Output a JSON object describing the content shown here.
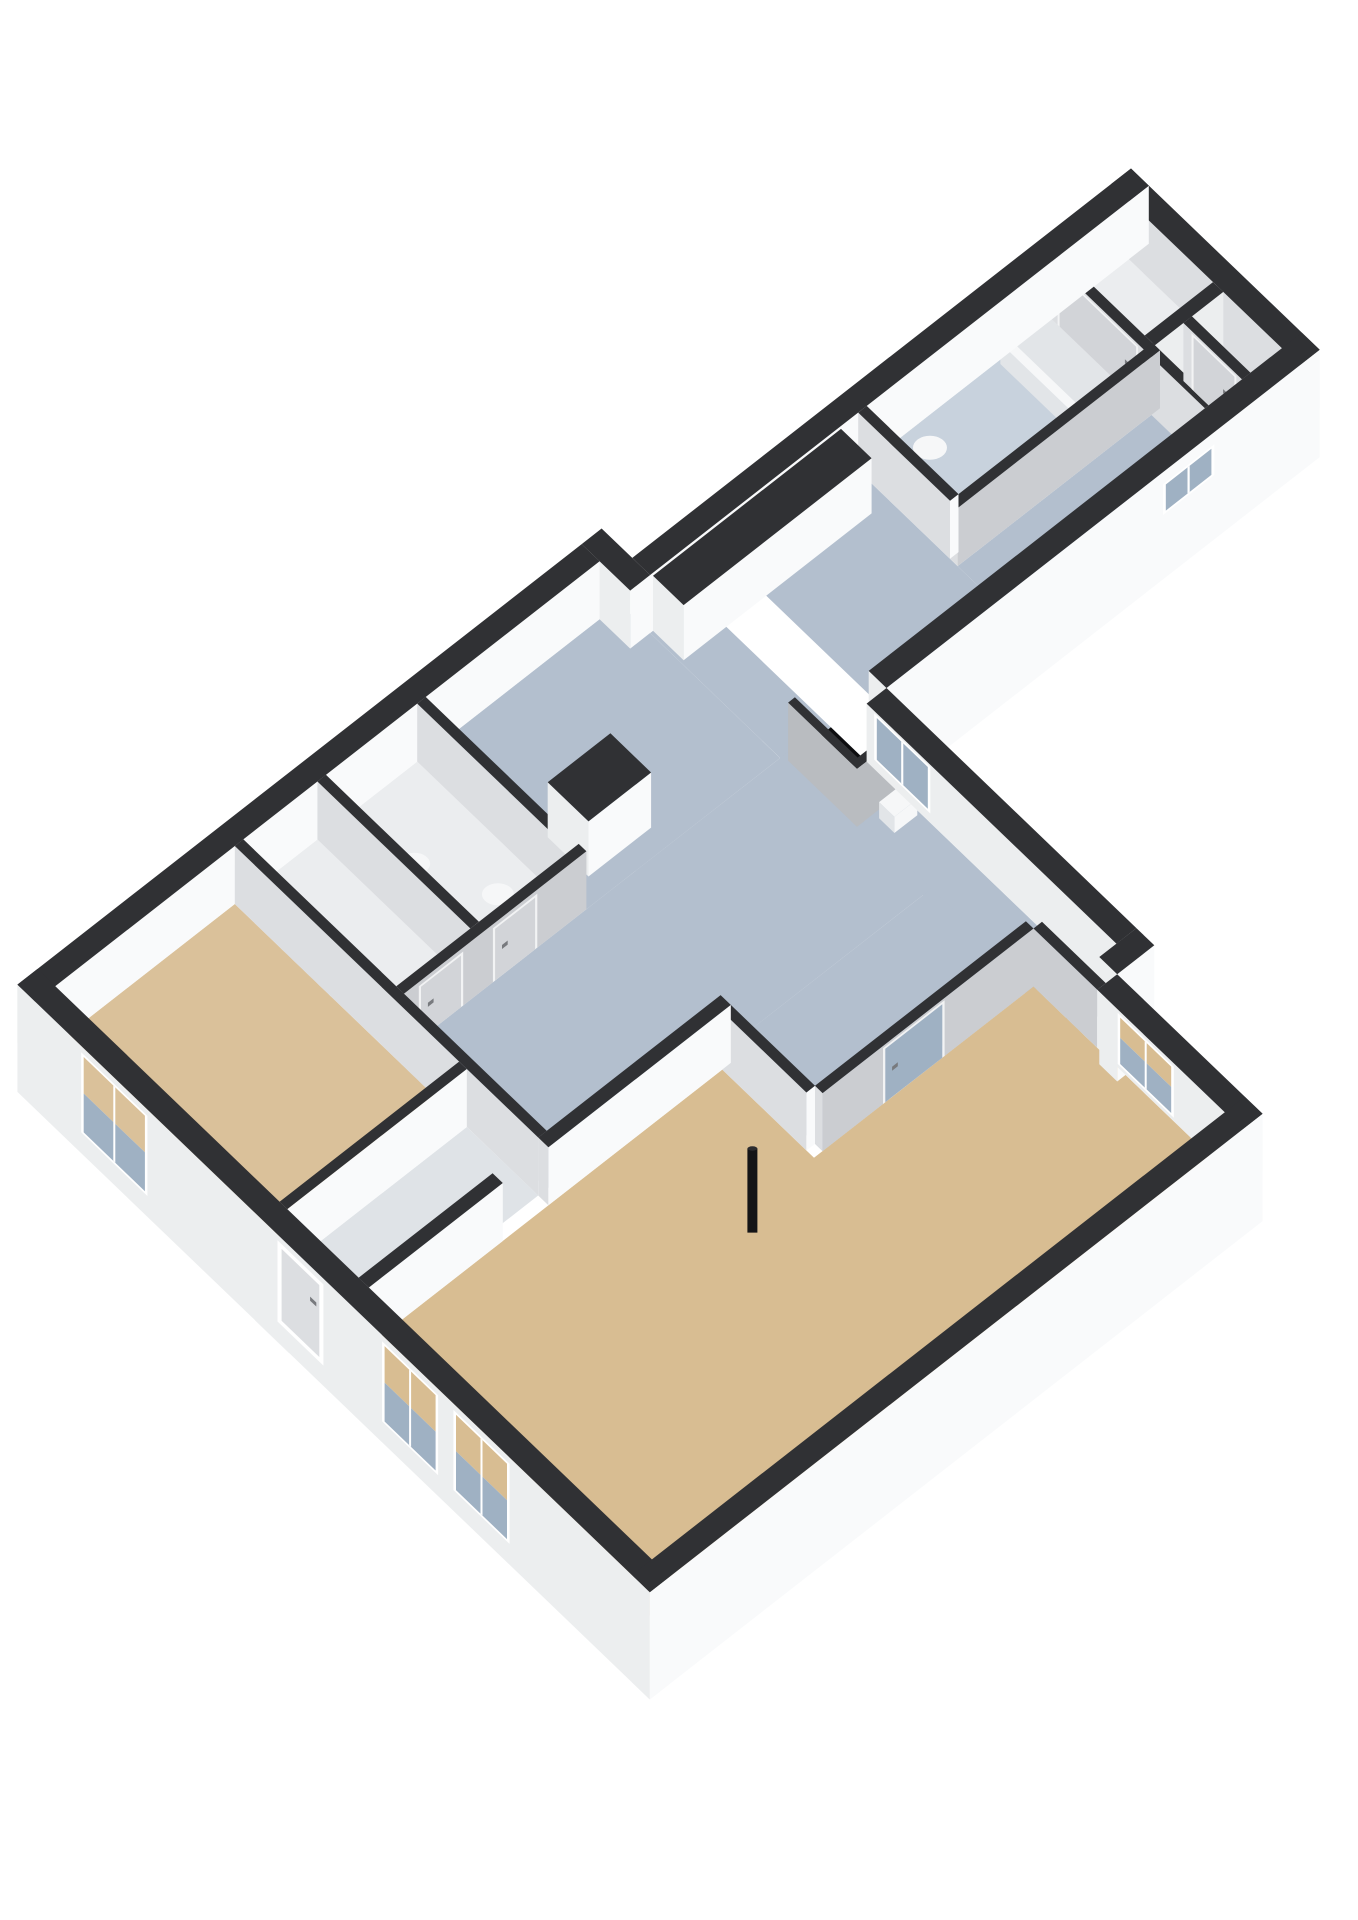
{
  "title": "3D cutaway floor plan (isometric view)",
  "view": "axonometric-cutaway",
  "background": "#ffffff",
  "palette": {
    "wall_cap": "#303134",
    "wall_face_bright": "#f9fafb",
    "wall_face_light": "#eceeef",
    "wall_face_mid": "#dcdee1",
    "wall_face_gray": "#cbcdd1",
    "door_panel": "#d2d4d8",
    "door_frame": "#f2f3f4",
    "door_handle": "#787a7e",
    "glass": "#9fb1c3",
    "glass_light": "#c3cdd8",
    "stair_void": "#0d0d0f",
    "stair_wall": "#b9bcc0",
    "flue_black": "#141416",
    "fixture_white": "#f6f7f8",
    "fixture_inner": "#e2e5e8"
  },
  "rooms": [
    {
      "id": "living-room",
      "label": "Living room",
      "floor_color": "#d8bd92"
    },
    {
      "id": "bedroom",
      "label": "Bedroom",
      "floor_color": "#dac19a"
    },
    {
      "id": "hall",
      "label": "Hall / landing",
      "floor_color": "#b3bfce"
    },
    {
      "id": "kitchen-zone",
      "label": "Kitchen zone",
      "floor_color": "#b3bfce"
    },
    {
      "id": "corridor",
      "label": "Corridor (rear wing)",
      "floor_color": "#b3bfce"
    },
    {
      "id": "bathroom-rear",
      "label": "Bathroom (rear wing)",
      "floor_color": "#c8d2dd"
    },
    {
      "id": "bathroom-front",
      "label": "Bathroom",
      "floor_color": "#ebedef"
    },
    {
      "id": "toilet-room",
      "label": "Toilet room",
      "floor_color": "#ebedef"
    },
    {
      "id": "entry",
      "label": "Entry",
      "floor_color": "#dfe3e7"
    },
    {
      "id": "closet-a",
      "label": "Closet",
      "floor_color": "#ebedef"
    },
    {
      "id": "closet-b",
      "label": "Closet",
      "floor_color": "#ebedef"
    }
  ],
  "fixtures": [
    {
      "id": "bathtub",
      "label": "Bathtub"
    },
    {
      "id": "toilet-rear",
      "label": "Toilet"
    },
    {
      "id": "toilet-front",
      "label": "Toilet"
    },
    {
      "id": "washbasin",
      "label": "Washbasin"
    },
    {
      "id": "kitchen-counter-long",
      "label": "Kitchen counter (dark top)"
    },
    {
      "id": "kitchen-counter-short",
      "label": "Kitchen counter (dark top)"
    },
    {
      "id": "stair-opening",
      "label": "Stair opening (void)"
    },
    {
      "id": "stair-step",
      "label": "Top stair step"
    },
    {
      "id": "flue-pipe",
      "label": "Black flue pipe"
    },
    {
      "id": "front-door",
      "label": "Front door with threshold"
    },
    {
      "id": "glass-door",
      "label": "Glazed interior door"
    }
  ],
  "openings": {
    "window_count": 9,
    "interior_door_count": 9,
    "exterior_door_count": 1
  }
}
